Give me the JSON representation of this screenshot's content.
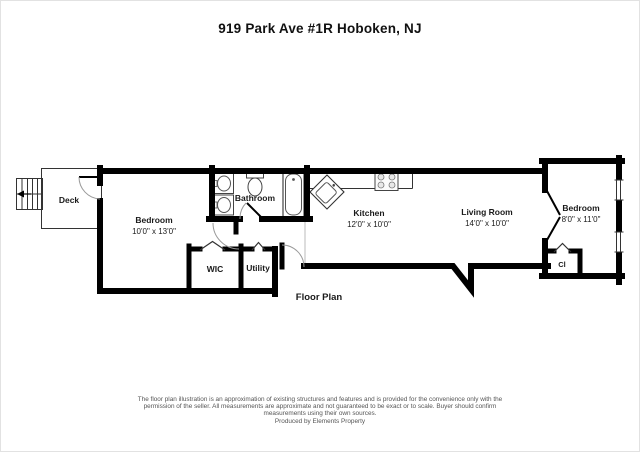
{
  "title": "919 Park Ave #1R Hoboken, NJ",
  "plan": {
    "caption": "Floor Plan",
    "rooms": {
      "deck": {
        "name": "Deck"
      },
      "bedroom1": {
        "name": "Bedroom",
        "dims": "10'0\" x 13'0\""
      },
      "bathroom": {
        "name": "Bathroom"
      },
      "wic": {
        "name": "WIC"
      },
      "utility": {
        "name": "Utility"
      },
      "kitchen": {
        "name": "Kitchen",
        "dims": "12'0\" x 10'0\""
      },
      "living": {
        "name": "Living Room",
        "dims": "14'0\" x 10'0\""
      },
      "bedroom2": {
        "name": "Bedroom",
        "dims": "8'0\" x 11'0\""
      },
      "closet": {
        "name": "Cl"
      }
    }
  },
  "footer": {
    "line1": "The floor plan illustration is an approximation of existing structures and features and is provided for the convenience only with the",
    "line2": "permission of the seller. All measurements are approximate and not guaranteed to be exact or to scale. Buyer should confirm",
    "line3": "measurements using their own sources.",
    "credit": "Produced by Elements Property"
  },
  "colors": {
    "wall": "#000000",
    "fixture_line": "#444444",
    "door_arc": "#999999",
    "label_text": "#1a1a1a",
    "disclaimer_text": "#555555"
  }
}
